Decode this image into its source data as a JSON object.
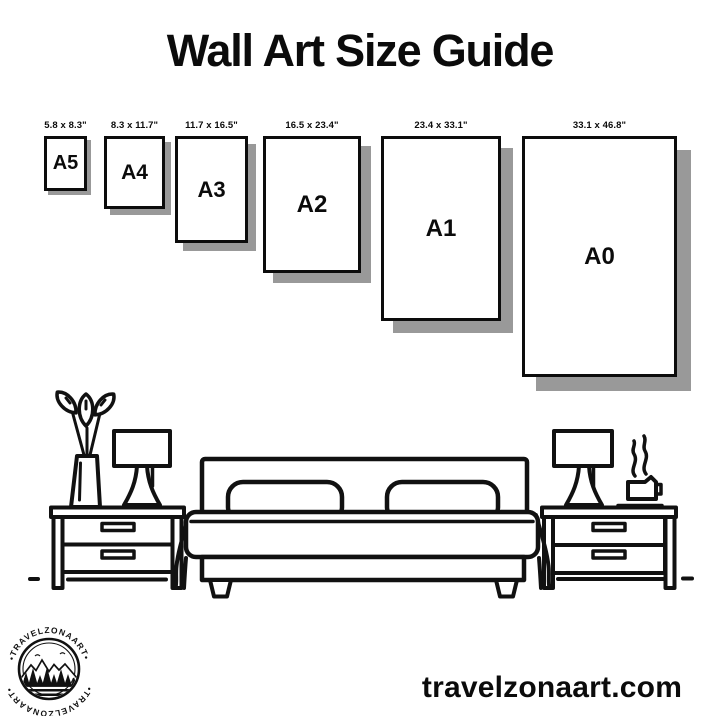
{
  "page": {
    "title": "Wall Art Size Guide",
    "website": "travelzonaart.com",
    "colors": {
      "ink": "#111111",
      "paper": "#ffffff",
      "shadow": "#999999"
    }
  },
  "size_guide": {
    "sizes": [
      {
        "code": "A5",
        "dimensions": "5.8 x 8.3\""
      },
      {
        "code": "A4",
        "dimensions": "8.3 x 11.7\""
      },
      {
        "code": "A3",
        "dimensions": "11.7 x 16.5\""
      },
      {
        "code": "A2",
        "dimensions": "16.5 x 23.4\""
      },
      {
        "code": "A1",
        "dimensions": "23.4 x 33.1\""
      },
      {
        "code": "A0",
        "dimensions": "33.1 x 46.8\""
      }
    ]
  },
  "illustration": {
    "items": [
      "vase-plant-icon",
      "table-lamp-icon",
      "nightstand-icon",
      "bed-icon",
      "coffee-cup-icon"
    ]
  },
  "logo": {
    "brand": "TRAVELZONAART",
    "ring_text_top": "•TRAVELZONAART•",
    "ring_text_bottom": "•TRAVELZONAART•"
  }
}
